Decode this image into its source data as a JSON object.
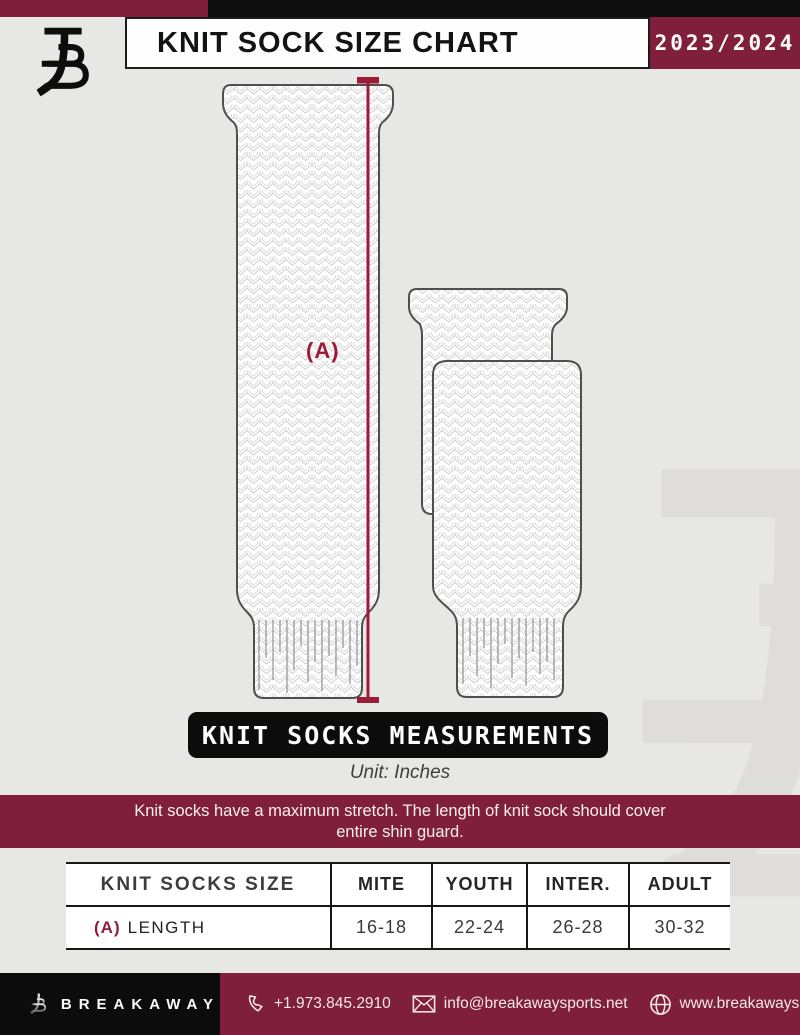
{
  "header": {
    "title": "KNIT SOCK SIZE CHART",
    "season": "2023/2024"
  },
  "diagram": {
    "dimension_label": "(A)"
  },
  "measurements": {
    "banner": "KNIT SOCKS MEASUREMENTS",
    "unit": "Unit: Inches"
  },
  "notice": {
    "line1": "Knit socks have a maximum stretch. The length of knit sock should cover",
    "line2": "entire shin guard."
  },
  "table": {
    "columns": [
      "KNIT SOCKS SIZE",
      "MITE",
      "YOUTH",
      "INTER.",
      "ADULT"
    ],
    "rows": [
      {
        "label_prefix": "(A)",
        "label": "LENGTH",
        "values": [
          "16-18",
          "22-24",
          "26-28",
          "30-32"
        ]
      }
    ]
  },
  "footer": {
    "brand": "BREAKAWAY",
    "phone": "+1.973.845.2910",
    "email": "info@breakawaysports.net",
    "website": "www.breakawaysports.net",
    "icons": [
      "phone-icon",
      "envelope-icon",
      "globe-icon"
    ]
  },
  "colors": {
    "maroon": "#7f1f3b",
    "crimson": "#9c1b35",
    "black": "#0d0d0d",
    "background": "#e7e7e5",
    "white": "#fefefe"
  }
}
